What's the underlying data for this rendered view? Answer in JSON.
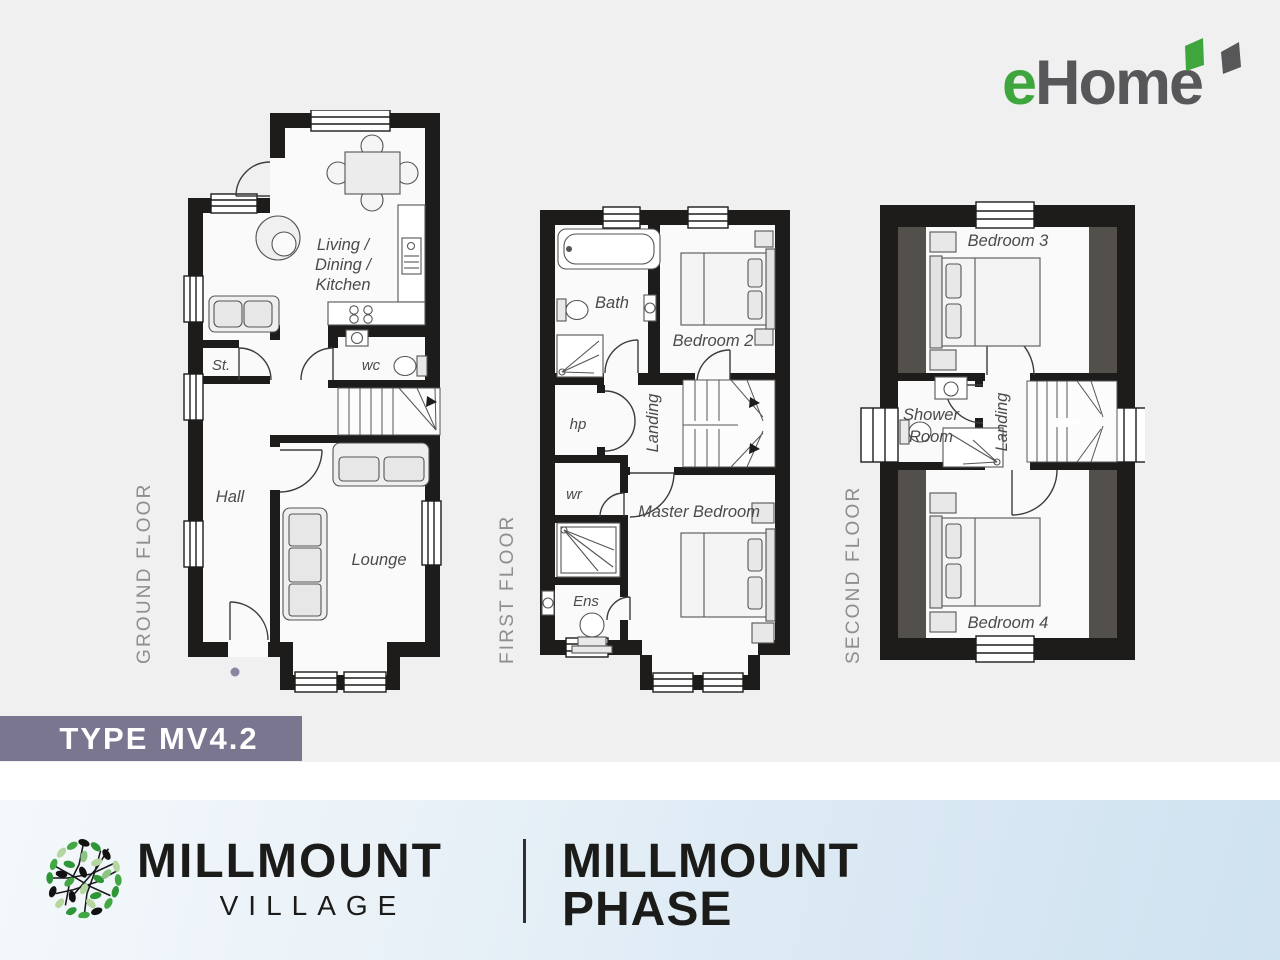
{
  "brand": {
    "ehome": {
      "green_part": "e",
      "gray_part": "Home",
      "green_color": "#3fa63e",
      "gray_color": "#57575a"
    },
    "village": {
      "line1": "MILLMOUNT",
      "line2": "VILLAGE"
    },
    "phase": {
      "line1": "MILLMOUNT",
      "line2": "PHASE"
    }
  },
  "type_banner": {
    "label": "TYPE MV4.2",
    "bg_color": "#7a7690",
    "text_color": "#ffffff"
  },
  "floors": {
    "ground": {
      "label": "GROUND FLOOR",
      "rooms": {
        "ldk1": "Living /",
        "ldk2": "Dining /",
        "ldk3": "Kitchen",
        "store": "St.",
        "wc": "wc",
        "hall": "Hall",
        "lounge": "Lounge"
      }
    },
    "first": {
      "label": "FIRST FLOOR",
      "rooms": {
        "bath": "Bath",
        "bedroom2": "Bedroom 2",
        "hp": "hp",
        "landing": "Landing",
        "wr": "wr",
        "master_bedroom": "Master Bedroom",
        "ensuite": "Ens"
      }
    },
    "second": {
      "label": "SECOND FLOOR",
      "rooms": {
        "bedroom3": "Bedroom 3",
        "shower_room_1": "Shower",
        "shower_room_2": "Room",
        "landing": "Landing",
        "bedroom4": "Bedroom 4"
      }
    }
  },
  "palette": {
    "wall": "#1d1c1a",
    "room_fill": "#fafafa",
    "eaves_shading": "#53504c",
    "plan_text": "#4b4b4b",
    "floor_label_gray": "#8e8e8e",
    "footer_blue_start": "#f4f8fb",
    "footer_blue_end": "#cfe2f0"
  }
}
